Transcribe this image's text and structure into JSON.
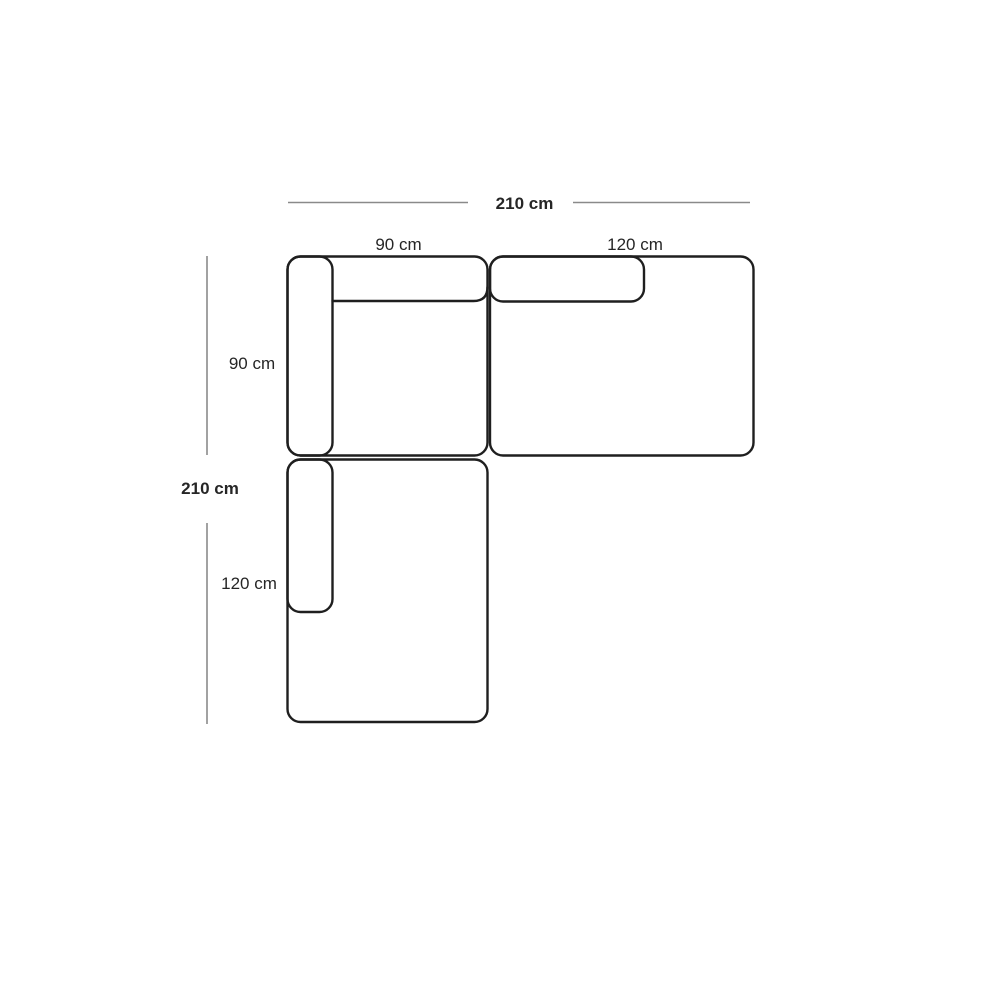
{
  "diagram": {
    "labels": {
      "total_width": "210 cm",
      "total_depth": "210 cm",
      "seat_module_width": "90 cm",
      "right_module_width": "120 cm",
      "seat_module_depth": "90 cm",
      "chaise_module_length": "120 cm"
    },
    "colors": {
      "outline": "#1f1f1f",
      "dimension_line": "#8a8a8a",
      "text": "#262626",
      "background": "#ffffff"
    }
  }
}
